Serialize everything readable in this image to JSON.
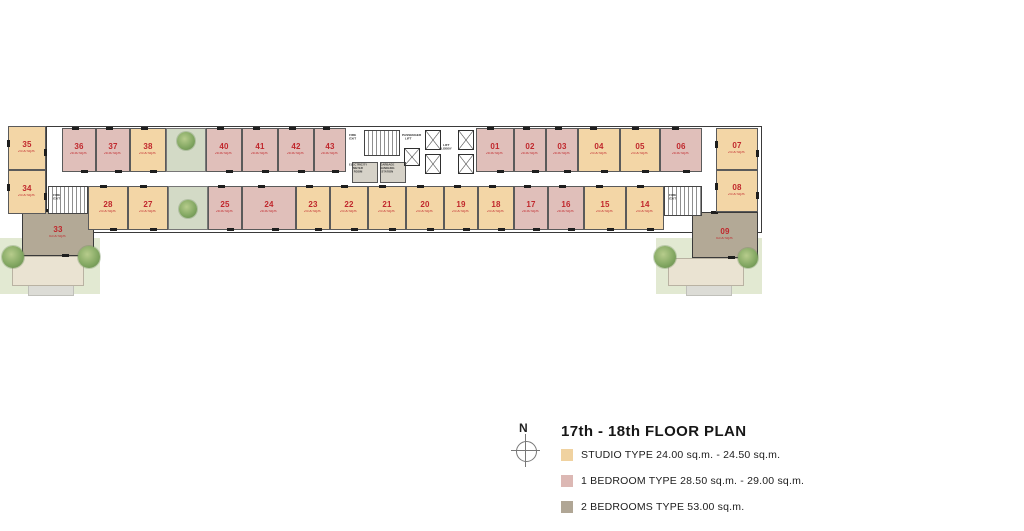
{
  "title": "17th - 18th FLOOR PLAN",
  "compass_label": "N",
  "legend": {
    "items": [
      {
        "label": "STUDIO TYPE 24.00 sq.m. - 24.50 sq.m.",
        "color": "#f0d2a0"
      },
      {
        "label": "1 BEDROOM TYPE 28.50 sq.m. - 29.00 sq.m.",
        "color": "#dcb8b4"
      },
      {
        "label": "2 BEDROOMS TYPE 53.00 sq.m.",
        "color": "#b0a695"
      }
    ]
  },
  "accent_color": "#c0272c",
  "core_labels": {
    "fire_exit": "FIRE EXIT",
    "passenger_lift": "PASSENGER LIFT",
    "lift_lobby": "LIFT LOBBY",
    "electricity_meter": "ELECTRICITY METER ROOM",
    "garbage": "GARBAGE HANDLING STATION"
  },
  "units": {
    "35": {
      "number": "35",
      "area": "24.00 sq.m."
    },
    "34": {
      "number": "34",
      "area": "24.00 sq.m."
    },
    "33": {
      "number": "33",
      "area": "53.00 sq.m."
    },
    "36": {
      "number": "36",
      "area": "28.50 sq.m."
    },
    "37": {
      "number": "37",
      "area": "28.50 sq.m."
    },
    "38": {
      "number": "38",
      "area": "24.00 sq.m."
    },
    "40": {
      "number": "40",
      "area": "28.50 sq.m."
    },
    "41": {
      "number": "41",
      "area": "28.50 sq.m."
    },
    "42": {
      "number": "42",
      "area": "28.50 sq.m."
    },
    "43": {
      "number": "43",
      "area": "28.50 sq.m."
    },
    "01": {
      "number": "01",
      "area": "28.50 sq.m."
    },
    "02": {
      "number": "02",
      "area": "28.50 sq.m."
    },
    "03": {
      "number": "03",
      "area": "28.50 sq.m."
    },
    "04": {
      "number": "04",
      "area": "24.00 sq.m."
    },
    "05": {
      "number": "05",
      "area": "24.00 sq.m."
    },
    "06": {
      "number": "06",
      "area": "28.50 sq.m."
    },
    "07": {
      "number": "07",
      "area": "24.00 sq.m."
    },
    "08": {
      "number": "08",
      "area": "24.00 sq.m."
    },
    "09": {
      "number": "09",
      "area": "53.00 sq.m."
    },
    "28": {
      "number": "28",
      "area": "24.00 sq.m."
    },
    "27": {
      "number": "27",
      "area": "24.00 sq.m."
    },
    "25": {
      "number": "25",
      "area": "28.50 sq.m."
    },
    "24": {
      "number": "24",
      "area": "28.50 sq.m."
    },
    "23": {
      "number": "23",
      "area": "24.00 sq.m."
    },
    "22": {
      "number": "22",
      "area": "24.00 sq.m."
    },
    "21": {
      "number": "21",
      "area": "24.00 sq.m."
    },
    "20": {
      "number": "20",
      "area": "24.00 sq.m."
    },
    "19": {
      "number": "19",
      "area": "24.00 sq.m."
    },
    "18": {
      "number": "18",
      "area": "24.00 sq.m."
    },
    "17": {
      "number": "17",
      "area": "28.50 sq.m."
    },
    "16": {
      "number": "16",
      "area": "28.50 sq.m."
    },
    "15": {
      "number": "15",
      "area": "24.00 sq.m."
    },
    "14": {
      "number": "14",
      "area": "24.00 sq.m."
    }
  }
}
